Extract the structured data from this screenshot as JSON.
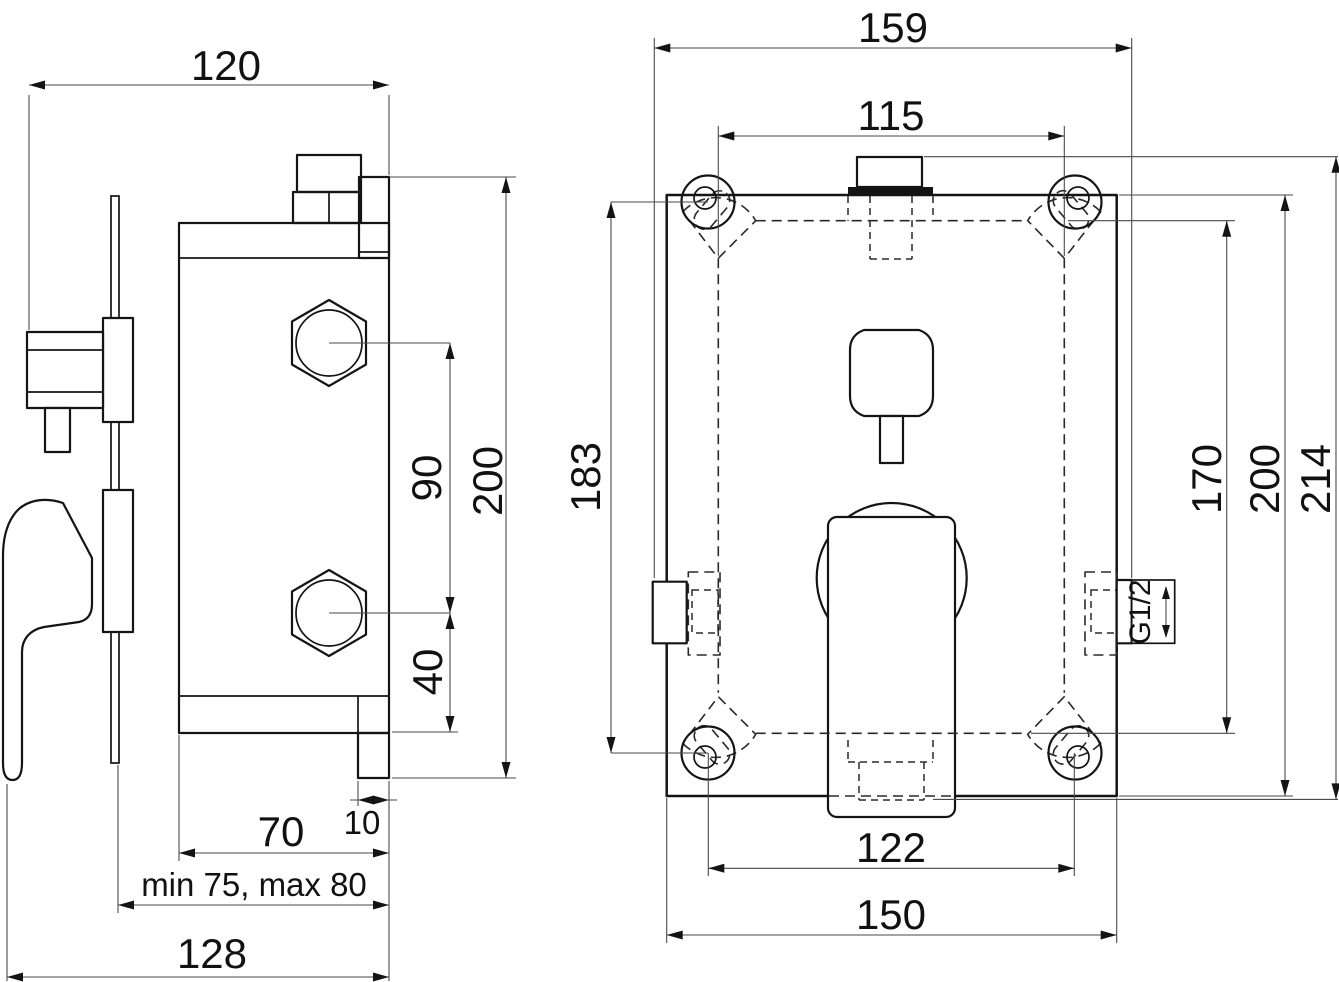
{
  "drawing": {
    "side_view": {
      "width": "120",
      "height": "200",
      "port_spacing": "90",
      "port_offset": "40",
      "body_depth": "70",
      "plaster_range": "min 75, max 80",
      "total_depth": "128",
      "flange_depth": "10"
    },
    "front_view": {
      "overall_width": "159",
      "recess_width": "115",
      "screw_vertical": "183",
      "recess_height": "170",
      "plate_height": "200",
      "overall_height": "214",
      "screw_horizontal": "122",
      "plate_width": "150",
      "thread_size": "G1/2"
    }
  }
}
